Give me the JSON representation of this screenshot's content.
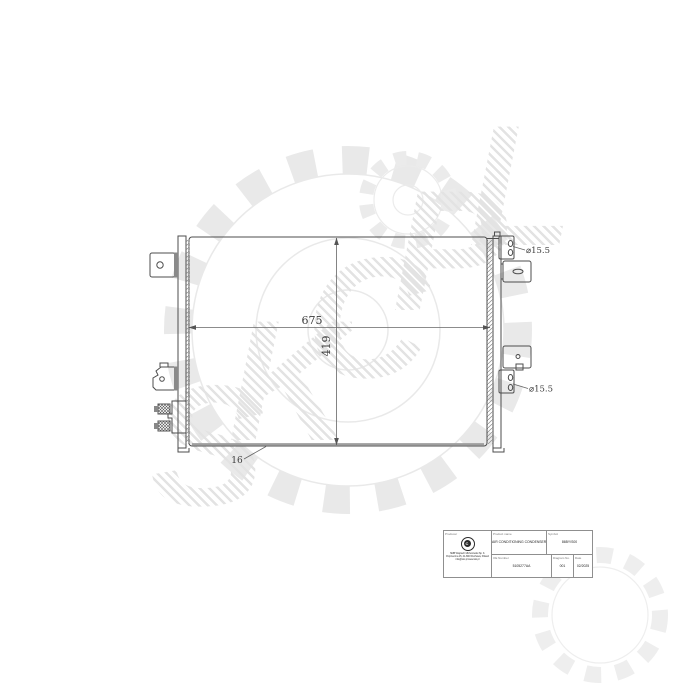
{
  "watermark": {
    "letters": [
      "S",
      "K",
      "C",
      "P",
      "L"
    ]
  },
  "drawing": {
    "width_dim": "675",
    "height_dim": "419",
    "core_thickness_dim": "16",
    "inlet_port_dim": "⌀15.5",
    "outlet_port_dim": "⌀15.5"
  },
  "title_block": {
    "producer": {
      "header": "Producer",
      "company_lines": [
        "SMB Wojciech Michorowski Sp. K.",
        "Poprzeczna 15, 41-800 Wschowa, Poland",
        "info@skc.pl  www.skc.pl"
      ]
    },
    "product": {
      "header": "Product name",
      "value": "AIR CONDITIONING CONDENSER"
    },
    "symbol": {
      "header": "Symbol",
      "value": "86BY/S00"
    },
    "oe_number": {
      "header": "OE Number",
      "value": "5105277AA"
    },
    "diagram_no": {
      "header": "Diagram No.",
      "value": "001"
    },
    "date": {
      "header": "Date",
      "value": "02/2025"
    }
  }
}
